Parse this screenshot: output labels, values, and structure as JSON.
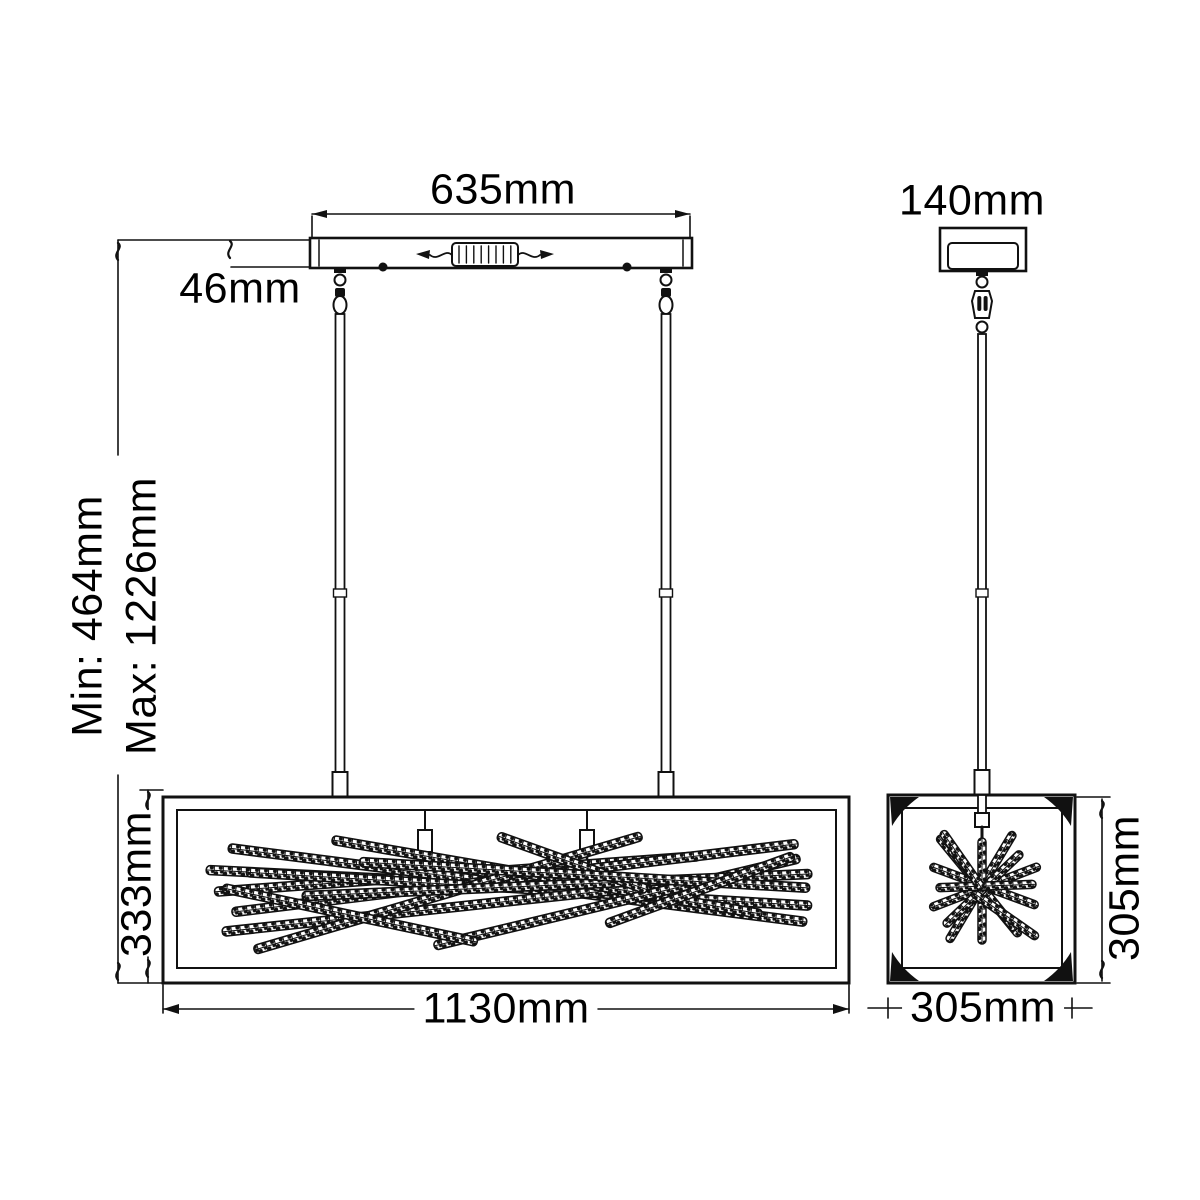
{
  "diagram": {
    "type": "pendant-light-dimension-drawing",
    "colors": {
      "line": "#111111",
      "background": "#ffffff",
      "text": "#000000"
    },
    "front_view": {
      "canopy_width_label": "635mm",
      "canopy_height_label": "46mm",
      "min_height_label": "Min: 464mm",
      "max_height_label": "Max: 1226mm",
      "body_height_label": "333mm",
      "body_width_label": "1130mm"
    },
    "side_view": {
      "canopy_width_label": "140mm",
      "body_height_label": "305mm",
      "body_width_label": "305mm"
    }
  }
}
